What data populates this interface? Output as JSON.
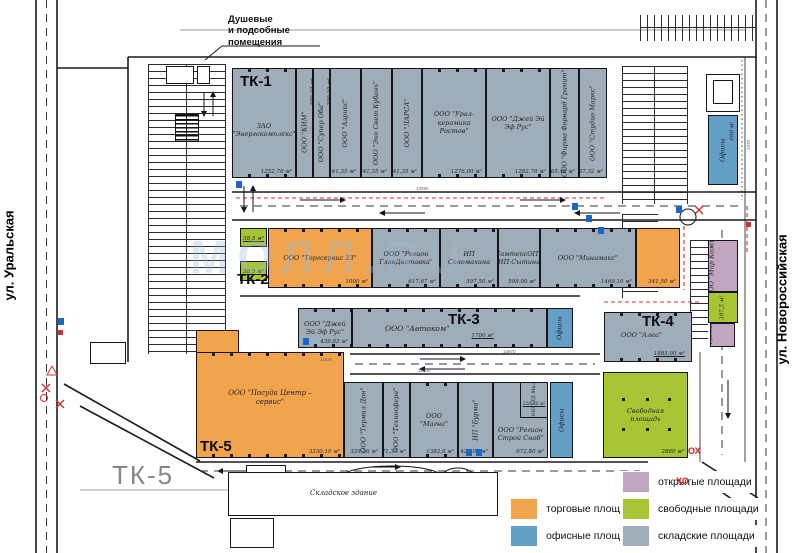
{
  "streets": {
    "left": "ул. Уральская",
    "right": "ул. Новороссийская"
  },
  "top_note": {
    "line1": "Душевые",
    "line2": "и подсобные",
    "line3": "помещения"
  },
  "watermark": "МОЛЛ.RU",
  "tk1": {
    "label": "ТК-1",
    "units": [
      {
        "name": "ЗАО \"Энергокомплекс\"",
        "area": "1252,70 м²"
      },
      {
        "name": "ООО \"КИМ\"",
        "area": "300,19 м²"
      },
      {
        "name": "ООО \"Супер Оба\"",
        "area": "300,19 м²"
      },
      {
        "name": "ООО \"Аэрикс\"",
        "area": "641,35 м²"
      },
      {
        "name": "ООО \"Эко Свет Кубань\"",
        "area": "641,35 м²"
      },
      {
        "name": "ООО \"ЛАРСА\"",
        "area": "641,35 м²"
      },
      {
        "name": "ООО \"Урал-керамика Ростов\"",
        "area": "1276,00 м²"
      },
      {
        "name": "ООО \"Джей Эй Эф Рус\"",
        "area": "1282,70 м²"
      },
      {
        "name": "ООО \"Фирма Форвард Гранит\"",
        "area": "665,40 м²"
      },
      {
        "name": "ООО \"Студио Маркс\"",
        "area": "637,32 м²"
      }
    ]
  },
  "offices_top": {
    "label": "Офисы",
    "area": "690 м²"
  },
  "tk2": {
    "label": "ТК-2",
    "free_units": [
      {
        "area": "58,5 м²"
      },
      {
        "area": "58,5 м²"
      }
    ],
    "units": [
      {
        "name": "ООО \"Торгсервис 23\"",
        "area": "1000 м²"
      },
      {
        "name": "ООО \"Регион ГлавДоставка\"",
        "area": "617,67 м²"
      },
      {
        "name": "ИП Соломахина",
        "area": "597,50 м²"
      },
      {
        "name": "СамтексОПТ ИП Сытина",
        "area": "599,00 м²"
      },
      {
        "name": "ООО \"Минимакс\"",
        "area": "1469,10 м²"
      },
      {
        "name": "",
        "area": "341,50 м²"
      }
    ]
  },
  "right_strip": {
    "units": [
      {
        "name": "ООО \"Мир Кожи\"",
        "area": "500 м²"
      },
      {
        "name": "",
        "area": "397,5 м²"
      },
      {
        "name": "ИП \"Гринвальд\"",
        "area": "100 м²"
      }
    ]
  },
  "tk3": {
    "label": "ТК-3",
    "offices": "Офисы",
    "units": [
      {
        "name": "ООО \"Джей Эй Эф Рус\"",
        "area": "439,83 м²"
      },
      {
        "name": "ООО \"Автоком\"",
        "area": "1700 м²"
      }
    ]
  },
  "tk4": {
    "label": "ТК-4",
    "name": "ООО \"Алеа\"",
    "area": "1885,00 м²"
  },
  "free_area": {
    "name": "Свободная площадь",
    "area": "2880 м²"
  },
  "tk5": {
    "label": "ТК-5",
    "name": "ООО \"Посуда Центр – сервис\"",
    "area": "3330,10 м²"
  },
  "bottom_row": {
    "offices": "Офисы",
    "units": [
      {
        "name": "ООО \"Термал Дон\"",
        "area": "329,36 м²"
      },
      {
        "name": "ООО \"Техносфера\"",
        "area": "671,37 м²"
      },
      {
        "name": "ООО \"Магна\"",
        "area": "1382,0 м²"
      },
      {
        "name": "ИП \"Бурма\"",
        "area": "425,00 м²"
      },
      {
        "name": "ООО \"Регион Строй Снаб\"",
        "area": "672,80 м²"
      },
      {
        "name": "ООО \"ТД Милка\"",
        "area": "220,00 м²"
      }
    ]
  },
  "warehouse": {
    "label": "ТК-5",
    "name": "Складское здание"
  },
  "legend": {
    "items": [
      {
        "label": "торговые площади",
        "color": "#f2a44d"
      },
      {
        "label": "офисные площади",
        "color": "#649fc8"
      },
      {
        "label": "открытые площади",
        "color": "#c2a6c0"
      },
      {
        "label": "свободные площади",
        "color": "#a8c634"
      },
      {
        "label": "складские площади",
        "color": "#9fadb8"
      }
    ]
  },
  "marks": {
    "red1": "ХО",
    "red2": "ОХ"
  },
  "dims": [
    "13590",
    "11830",
    "14970",
    "12030",
    "1970"
  ]
}
